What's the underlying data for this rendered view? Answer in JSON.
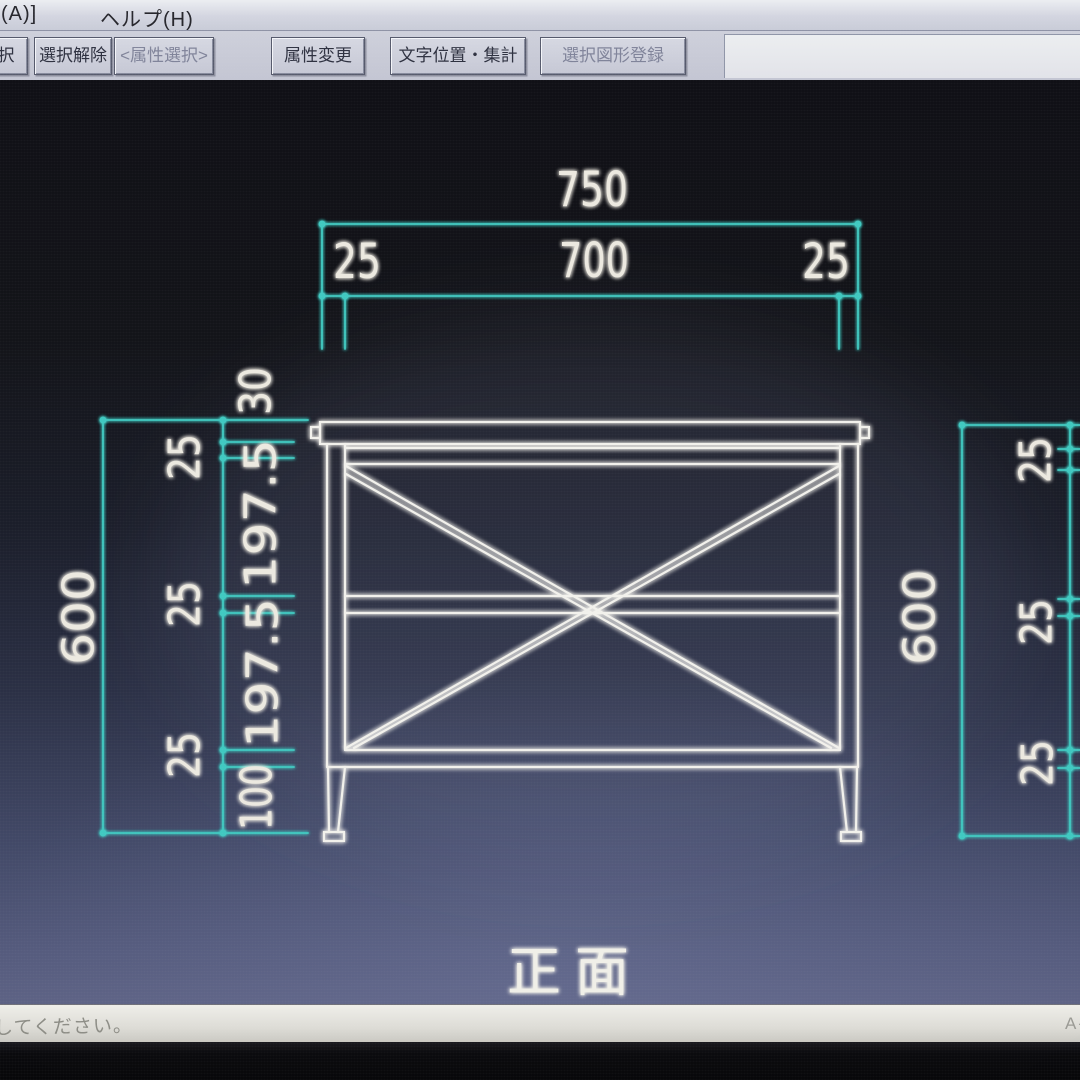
{
  "menu_bar": {
    "items": [
      {
        "label": "(A)]"
      },
      {
        "label": "ヘルプ(H)"
      }
    ]
  },
  "toolbar": {
    "buttons": [
      {
        "label": "択",
        "enabled": true
      },
      {
        "label": "選択解除",
        "enabled": true
      },
      {
        "label": "<属性選択>",
        "enabled": false
      },
      {
        "label": "属性変更",
        "enabled": true
      },
      {
        "label": "文字位置・集計",
        "enabled": true
      },
      {
        "label": "選択図形登録",
        "enabled": false
      }
    ]
  },
  "canvas": {
    "view_label": "正面",
    "colors": {
      "dimension_line": "#41c9c1",
      "drawing_line": "#f2f1ec",
      "dimension_text": "#ece9e0"
    },
    "dimensions": {
      "top_overall": "750",
      "top_left": "25",
      "top_center": "700",
      "top_right": "25",
      "left_overall": "600",
      "left_chain": {
        "s1": "30",
        "s2": "25",
        "s3": "197.5",
        "s4": "25",
        "s5": "197.5",
        "s6": "25",
        "s7": "100"
      },
      "right_overall": "600",
      "right_chain": {
        "s1": "25",
        "s2": "25",
        "s3": "25"
      }
    }
  },
  "status_bar": {
    "message": "してください。",
    "right_label": "A-"
  }
}
